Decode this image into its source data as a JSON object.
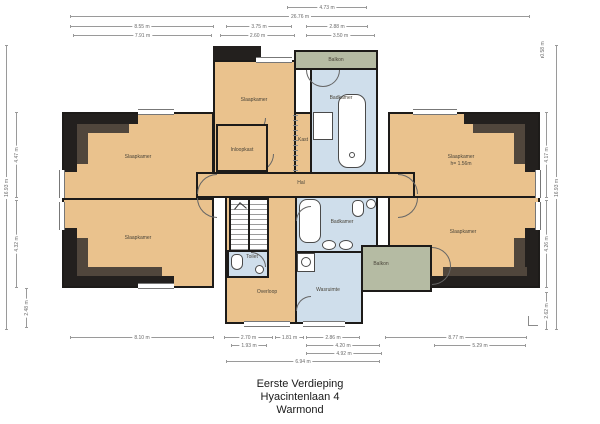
{
  "title_block": {
    "line1": "Eerste Verdieping",
    "line2": "Hyacintenlaan 4",
    "line3": "Warmond"
  },
  "colors": {
    "floor": "#eac28d",
    "wet_room": "#cfdeeb",
    "balcony": "#b5bba3",
    "wall": "#1d1b19",
    "roof_outer": "#23201e",
    "roof_inner": "#50463c",
    "dimension_line": "#9a9a9a",
    "background": "#ffffff"
  },
  "rooms": {
    "slaapkamer_tl": "Slaapkamer",
    "slaapkamer_bl": "Slaapkamer",
    "slaapkamer_tc": "Slaapkamer",
    "inloopkast": "Inloopkast",
    "kast": "Kast",
    "badkamer_top": "Badkamer",
    "balkon_top": "Balkon",
    "hal": "Hal",
    "toilet": "Toilet",
    "overloop": "Overloop",
    "badkamer_mid": "Badkamer",
    "wasruimte": "Wasruimte",
    "balkon_right": "Balkon",
    "slaapkamer_tr": "Slaapkamer",
    "slaapkamer_tr_note": "h= 1.56m",
    "slaapkamer_br": "Slaapkamer"
  },
  "dims": {
    "top": [
      {
        "label": "4.73 m"
      },
      {
        "label": "26.76 m"
      },
      {
        "label": "8.55 m"
      },
      {
        "label": "3.75 m"
      },
      {
        "label": "2.88 m"
      },
      {
        "label": "7.91 m"
      },
      {
        "label": "2.60 m"
      },
      {
        "label": "3.50 m"
      }
    ],
    "bottom": [
      {
        "label": "8.10 m"
      },
      {
        "label": "2.70 m"
      },
      {
        "label": "1.81 m"
      },
      {
        "label": "2.86 m"
      },
      {
        "label": "8.77 m"
      },
      {
        "label": "1.93 m"
      },
      {
        "label": "4.20 m"
      },
      {
        "label": "5.29 m"
      },
      {
        "label": "4.92 m"
      },
      {
        "label": "6.94 m"
      }
    ],
    "left": [
      {
        "label": "16.93 m"
      },
      {
        "label": "4.47 m"
      },
      {
        "label": "4.32 m"
      },
      {
        "label": "2.48 m"
      }
    ],
    "right": [
      {
        "label": "0.58 m"
      },
      {
        "label": "4.17 m"
      },
      {
        "label": "4.26 m"
      },
      {
        "label": "2.62 m"
      },
      {
        "label": "16.93 m"
      }
    ]
  }
}
